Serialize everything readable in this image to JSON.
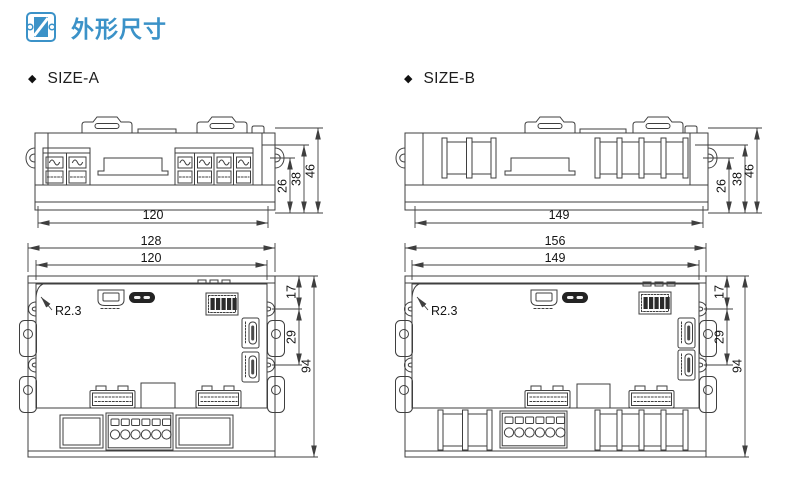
{
  "header": {
    "title": "外形尺寸"
  },
  "sections": {
    "size_a": {
      "bullet": "◆",
      "label": "SIZE-A",
      "side_view": {
        "width_mm": "120",
        "dim_26": "26",
        "dim_38": "38",
        "dim_46": "46"
      },
      "front_view": {
        "width_outer": "128",
        "width_inner": "120",
        "dim_17": "17",
        "dim_29": "29",
        "dim_94": "94",
        "corner_radius": "R2.3"
      }
    },
    "size_b": {
      "bullet": "◆",
      "label": "SIZE-B",
      "side_view": {
        "width_mm": "149",
        "dim_26": "26",
        "dim_38": "38",
        "dim_46": "46"
      },
      "front_view": {
        "width_outer": "156",
        "width_inner": "149",
        "dim_17": "17",
        "dim_29": "29",
        "dim_94": "94",
        "corner_radius": "R2.3"
      }
    }
  },
  "colors": {
    "accent": "#3b92c8",
    "line": "#3f3f3f"
  }
}
